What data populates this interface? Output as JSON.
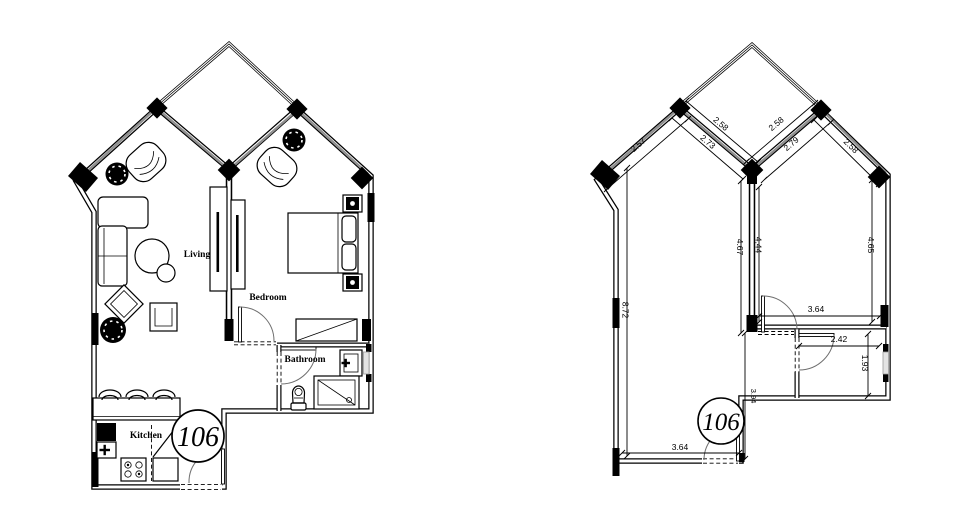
{
  "unit": {
    "number": "106"
  },
  "furnished_plan": {
    "room_labels": {
      "living": "Living",
      "bedroom": "Bedroom",
      "bathroom": "Bathroom",
      "kitchen": "Kitchen"
    },
    "unit_number": "106"
  },
  "dimension_plan": {
    "unit_number": "106",
    "dims": {
      "outer_left_slope": "2.57",
      "window_left": "2.73",
      "balcony_left": "2.58",
      "balcony_right": "2.58",
      "window_right": "2.79",
      "outer_right_slope": "2.58",
      "living_depth": "4.67",
      "bedroom_depth_left": "4.44",
      "bedroom_depth_right": "4.65",
      "left_wall": "8.72",
      "bedroom_width": "3.64",
      "bathroom_width": "2.42",
      "bathroom_depth": "1.93",
      "hall_depth": "3.94",
      "kitchen_width": "3.64"
    }
  },
  "colors": {
    "background": "#ffffff",
    "line": "#000000",
    "glazing": "#8f8f8f",
    "window_fill": "#e3e3e3"
  }
}
